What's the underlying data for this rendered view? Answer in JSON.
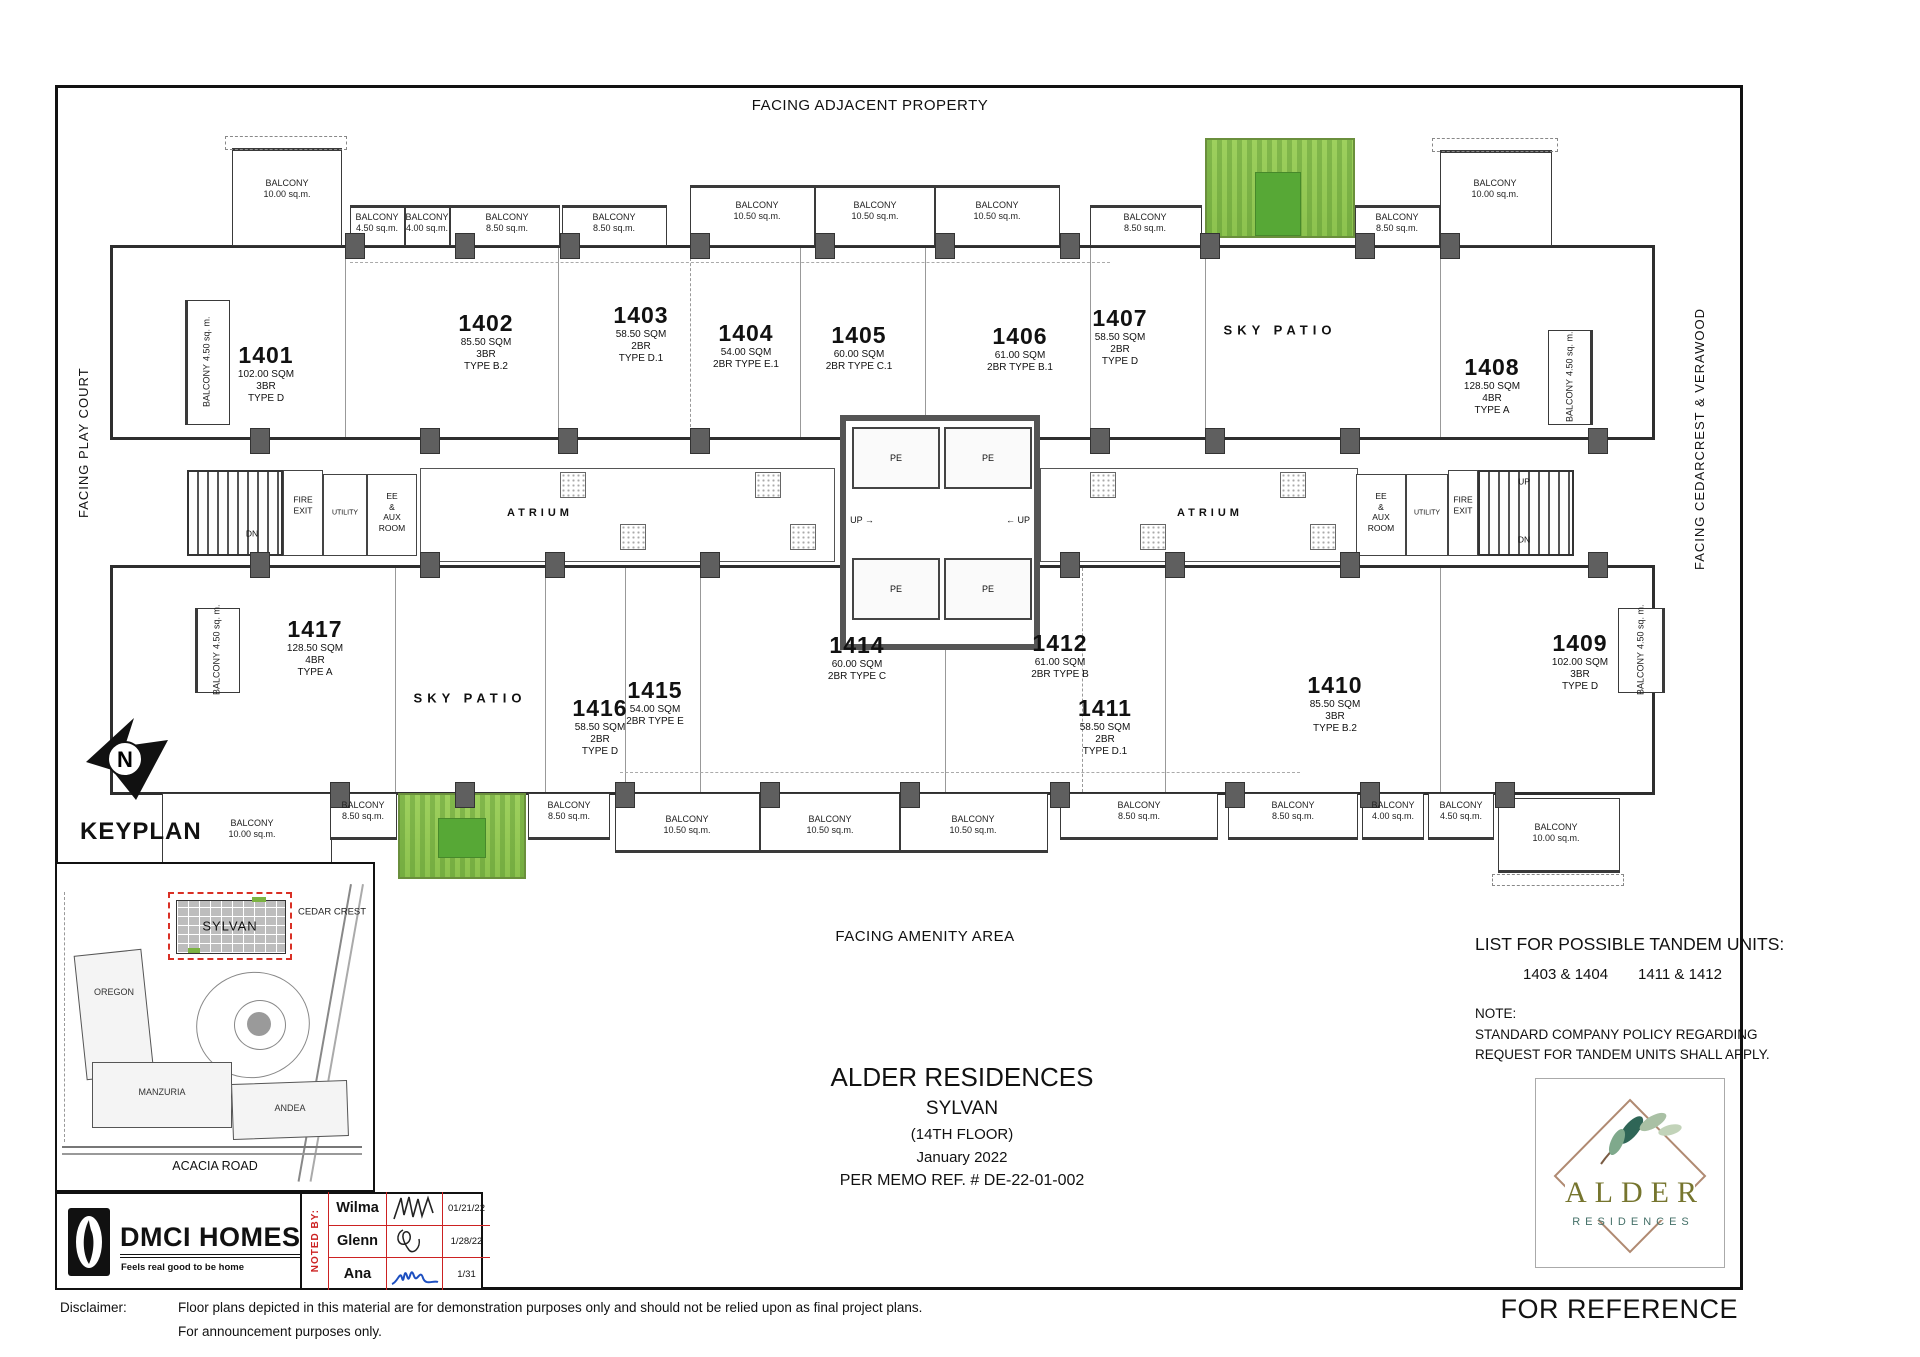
{
  "frame": {
    "facing_top": "FACING ADJACENT PROPERTY",
    "facing_left": "FACING PLAY COURT",
    "facing_right": "FACING CEDARCREST & VERAWOOD",
    "facing_bottom": "FACING AMENITY AREA"
  },
  "plan": {
    "balcony_label": "BALCONY",
    "atrium": "ATRIUM",
    "sky_patio": "SKY PATIO",
    "pe": "PE",
    "up": "UP",
    "dn": "DN",
    "utility": "UTILITY",
    "fire_exit_lines": [
      "FIRE",
      "EXIT"
    ],
    "ee_aux_lines": [
      "EE",
      "&",
      "AUX",
      "ROOM"
    ],
    "balconies": [
      {
        "size": "10.00 sq.m."
      },
      {
        "size": "4.50 sq.m."
      },
      {
        "size": "4.00 sq.m."
      },
      {
        "size": "8.50 sq.m."
      },
      {
        "size": "8.50 sq.m."
      },
      {
        "size": "10.50 sq.m."
      },
      {
        "size": "10.50 sq.m."
      },
      {
        "size": "10.50 sq.m."
      },
      {
        "size": "8.50 sq.m."
      },
      {
        "size": "8.50 sq.m."
      },
      {
        "size": "10.00 sq.m."
      },
      {
        "size": "4.50 sq. m."
      },
      {
        "size": "4.50 sq. m."
      },
      {
        "size": "4.50 sq. m."
      },
      {
        "size": "4.50 sq. m."
      },
      {
        "size": "10.00 sq.m."
      },
      {
        "size": "8.50 sq.m."
      },
      {
        "size": "8.50 sq.m."
      },
      {
        "size": "10.50 sq.m."
      },
      {
        "size": "10.50 sq.m."
      },
      {
        "size": "10.50 sq.m."
      },
      {
        "size": "8.50 sq.m."
      },
      {
        "size": "8.50 sq.m."
      },
      {
        "size": "4.00 sq.m."
      },
      {
        "size": "4.50 sq.m."
      },
      {
        "size": "10.00 sq.m."
      }
    ],
    "units": [
      {
        "num": "1401",
        "lines": [
          "102.00 SQM",
          "3BR",
          "TYPE D"
        ]
      },
      {
        "num": "1402",
        "lines": [
          "85.50 SQM",
          "3BR",
          "TYPE B.2"
        ]
      },
      {
        "num": "1403",
        "lines": [
          "58.50 SQM",
          "2BR",
          "TYPE D.1"
        ]
      },
      {
        "num": "1404",
        "lines": [
          "54.00 SQM",
          "2BR TYPE E.1"
        ]
      },
      {
        "num": "1405",
        "lines": [
          "60.00 SQM",
          "2BR TYPE C.1"
        ]
      },
      {
        "num": "1406",
        "lines": [
          "61.00 SQM",
          "2BR TYPE B.1"
        ]
      },
      {
        "num": "1407",
        "lines": [
          "58.50 SQM",
          "2BR",
          "TYPE D"
        ]
      },
      {
        "num": "1408",
        "lines": [
          "128.50 SQM",
          "4BR",
          "TYPE A"
        ]
      },
      {
        "num": "1409",
        "lines": [
          "102.00 SQM",
          "3BR",
          "TYPE D"
        ]
      },
      {
        "num": "1410",
        "lines": [
          "85.50 SQM",
          "3BR",
          "TYPE B.2"
        ]
      },
      {
        "num": "1411",
        "lines": [
          "58.50 SQM",
          "2BR",
          "TYPE D.1"
        ]
      },
      {
        "num": "1412",
        "lines": [
          "61.00 SQM",
          "2BR TYPE B"
        ]
      },
      {
        "num": "1414",
        "lines": [
          "60.00 SQM",
          "2BR TYPE C"
        ]
      },
      {
        "num": "1415",
        "lines": [
          "54.00 SQM",
          "2BR TYPE E"
        ]
      },
      {
        "num": "1416",
        "lines": [
          "58.50 SQM",
          "2BR",
          "TYPE D"
        ]
      },
      {
        "num": "1417",
        "lines": [
          "128.50 SQM",
          "4BR",
          "TYPE A"
        ]
      }
    ]
  },
  "icons": {
    "arrow_right": "→",
    "arrow_left": "←"
  },
  "keyplan": {
    "label": "KEYPLAN",
    "north_letter": "N"
  },
  "sitemap": {
    "highlight": "SYLVAN",
    "cedar": "CEDAR CREST",
    "oregon": "OREGON",
    "manzuria": "MANZURIA",
    "andea": "ANDEA",
    "road": "ACACIA ROAD"
  },
  "title_block": {
    "project": "ALDER RESIDENCES",
    "building": "SYLVAN",
    "floor": "(14TH FLOOR)",
    "date": "January 2022",
    "memo": "PER MEMO REF. # DE-22-01-002"
  },
  "notes": {
    "tandem_heading": "LIST FOR POSSIBLE TANDEM UNITS:",
    "pair1": "1403 & 1404",
    "pair2": "1411 & 1412",
    "note_label": "NOTE:",
    "note_line1": "STANDARD COMPANY POLICY REGARDING",
    "note_line2": "REQUEST FOR TANDEM UNITS SHALL APPLY."
  },
  "alder_logo": {
    "name": "ALDER",
    "sub": "RESIDENCES"
  },
  "dmci": {
    "name": "DMCI HOMES",
    "tagline": "Feels real good to be home"
  },
  "noted_by": {
    "label": "NOTED BY:",
    "rows": [
      {
        "name": "Wilma",
        "date": "01/21/22"
      },
      {
        "name": "Glenn",
        "date": "1/28/22"
      },
      {
        "name": "Ana",
        "date": "1/31"
      }
    ]
  },
  "footer": {
    "disclaimer_label": "Disclaimer:",
    "line1": "Floor plans depicted in this material are for demonstration purposes only and should not be relied upon as final project plans.",
    "line2": "For announcement purposes only.",
    "reference": "FOR REFERENCE"
  }
}
